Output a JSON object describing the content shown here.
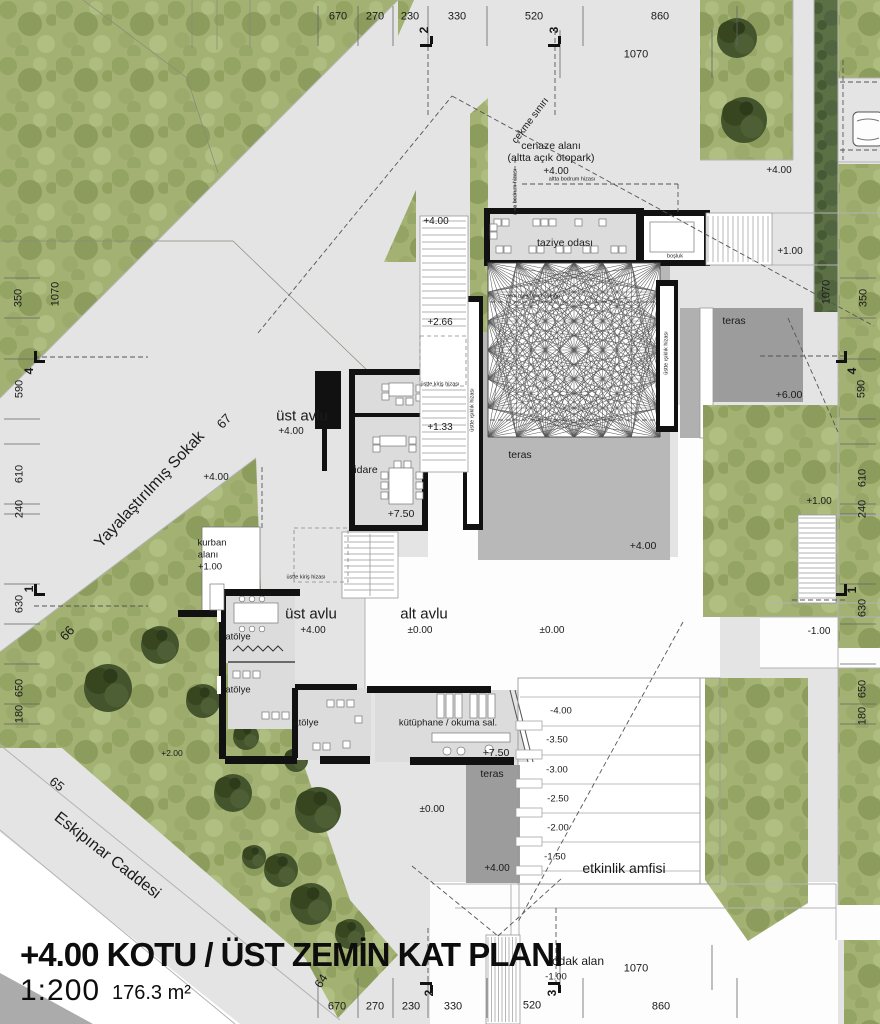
{
  "title": {
    "main": "+4.00 KOTU / ÜST ZEMİN KAT PLANI",
    "scale": "1:200",
    "area": "176.3 m²"
  },
  "plan": {
    "rooms": [
      "taziye odası",
      "boşluk",
      "cem meydanı boşluğu",
      "teras",
      "idare",
      "üst avlu",
      "alt avlu",
      "atölye",
      "kurban alanı",
      "kütüphane / okuma sal.",
      "etkinlik amfisi",
      "odak alan",
      "cenaze alanı (altta açık otopark)"
    ],
    "streets": [
      "Yayalaştırılmış Sokak",
      "Eskipınar Caddesi"
    ],
    "levels_shown": [
      "+7.50",
      "+6.00",
      "+4.00",
      "+2.66",
      "+2.00",
      "+1.33",
      "+1.00",
      "±0.00",
      "-1.00",
      "-1.50",
      "-2.00",
      "-2.50",
      "-3.00",
      "-3.50",
      "-4.00"
    ],
    "colors": {
      "grass": "#a3b173",
      "hedge": "#5b7044",
      "pavement": "#e4e4e4",
      "terrace_gray": "#9c9c9c",
      "terrace_light": "#b8b8b8",
      "wall": "#111111"
    }
  },
  "dimensions": {
    "top": [
      "670",
      "270",
      "230",
      "330",
      "520",
      "860",
      "1070"
    ],
    "bottom": [
      "670",
      "270",
      "230",
      "330",
      "520",
      "860",
      "1070"
    ],
    "left": [
      "350",
      "1070",
      "590",
      "610",
      "240",
      "630",
      "650",
      "180"
    ],
    "right": [
      "1070",
      "350",
      "590",
      "610",
      "240",
      "630",
      "650",
      "180"
    ],
    "section_markers": [
      "1",
      "2",
      "3",
      "4"
    ],
    "street_numbers": [
      "64",
      "65",
      "66",
      "67"
    ]
  },
  "labels": [
    {
      "n": "dim-top-670",
      "t": "670",
      "x": 338,
      "y": 17,
      "s": 11
    },
    {
      "n": "dim-top-270",
      "t": "270",
      "x": 375,
      "y": 17,
      "s": 11
    },
    {
      "n": "dim-top-230",
      "t": "230",
      "x": 410,
      "y": 17,
      "s": 11
    },
    {
      "n": "dim-top-330",
      "t": "330",
      "x": 457,
      "y": 17,
      "s": 11
    },
    {
      "n": "dim-top-520",
      "t": "520",
      "x": 534,
      "y": 17,
      "s": 11
    },
    {
      "n": "dim-top-860",
      "t": "860",
      "x": 660,
      "y": 17,
      "s": 11
    },
    {
      "n": "dim-top-1070",
      "t": "1070",
      "x": 636,
      "y": 55,
      "s": 11
    },
    {
      "n": "dim-bottom-670",
      "t": "670",
      "x": 337,
      "y": 1007,
      "s": 11
    },
    {
      "n": "dim-bottom-270",
      "t": "270",
      "x": 375,
      "y": 1007,
      "s": 11
    },
    {
      "n": "dim-bottom-230",
      "t": "230",
      "x": 411,
      "y": 1007,
      "s": 11
    },
    {
      "n": "dim-bottom-330",
      "t": "330",
      "x": 453,
      "y": 1007,
      "s": 11
    },
    {
      "n": "dim-bottom-520",
      "t": "520",
      "x": 532,
      "y": 1006,
      "s": 11
    },
    {
      "n": "dim-bottom-860",
      "t": "860",
      "x": 661,
      "y": 1007,
      "s": 11
    },
    {
      "n": "dim-bottom-1070",
      "t": "1070",
      "x": 636,
      "y": 969,
      "s": 11
    },
    {
      "n": "dim-left-350",
      "t": "350",
      "x": 19,
      "y": 298,
      "r": -90,
      "s": 11
    },
    {
      "n": "dim-left-1070",
      "t": "1070",
      "x": 56,
      "y": 294,
      "r": -90,
      "s": 11
    },
    {
      "n": "dim-left-590",
      "t": "590",
      "x": 20,
      "y": 389,
      "r": -90,
      "s": 11
    },
    {
      "n": "dim-left-610",
      "t": "610",
      "x": 20,
      "y": 474,
      "r": -90,
      "s": 11
    },
    {
      "n": "dim-left-240",
      "t": "240",
      "x": 20,
      "y": 509,
      "r": -90,
      "s": 11
    },
    {
      "n": "dim-left-630",
      "t": "630",
      "x": 20,
      "y": 604,
      "r": -90,
      "s": 11
    },
    {
      "n": "dim-left-650",
      "t": "650",
      "x": 20,
      "y": 688,
      "r": -90,
      "s": 11
    },
    {
      "n": "dim-left-180",
      "t": "180",
      "x": 20,
      "y": 714,
      "r": -90,
      "s": 11
    },
    {
      "n": "dim-right-350",
      "t": "350",
      "x": 864,
      "y": 298,
      "r": -90,
      "s": 11
    },
    {
      "n": "dim-right-1070",
      "t": "1070",
      "x": 827,
      "y": 292,
      "r": -90,
      "s": 11
    },
    {
      "n": "dim-right-590",
      "t": "590",
      "x": 862,
      "y": 389,
      "r": -90,
      "s": 11
    },
    {
      "n": "dim-right-610",
      "t": "610",
      "x": 863,
      "y": 478,
      "r": -90,
      "s": 11
    },
    {
      "n": "dim-right-240",
      "t": "240",
      "x": 863,
      "y": 509,
      "r": -90,
      "s": 11
    },
    {
      "n": "dim-right-630",
      "t": "630",
      "x": 863,
      "y": 608,
      "r": -90,
      "s": 11
    },
    {
      "n": "dim-right-650",
      "t": "650",
      "x": 863,
      "y": 689,
      "r": -90,
      "s": 11
    },
    {
      "n": "dim-right-180",
      "t": "180",
      "x": 863,
      "y": 716,
      "r": -90,
      "s": 11
    },
    {
      "n": "section-marker-2-top",
      "t": "2",
      "x": 424,
      "y": 30,
      "r": -90,
      "s": 12,
      "w": 700
    },
    {
      "n": "section-marker-3-top",
      "t": "3",
      "x": 554,
      "y": 30,
      "r": -90,
      "s": 12,
      "w": 700
    },
    {
      "n": "section-marker-2-bottom",
      "t": "2",
      "x": 429,
      "y": 993,
      "r": -90,
      "s": 12,
      "w": 700
    },
    {
      "n": "section-marker-3-bottom",
      "t": "3",
      "x": 552,
      "y": 993,
      "r": -90,
      "s": 12,
      "w": 700
    },
    {
      "n": "section-marker-4-left",
      "t": "4",
      "x": 29,
      "y": 371,
      "r": -90,
      "s": 12,
      "w": 700
    },
    {
      "n": "section-marker-1-left",
      "t": "1",
      "x": 29,
      "y": 589,
      "r": -90,
      "s": 12,
      "w": 700
    },
    {
      "n": "section-marker-4-right",
      "t": "4",
      "x": 852,
      "y": 371,
      "r": -90,
      "s": 12,
      "w": 700
    },
    {
      "n": "section-marker-1-right",
      "t": "1",
      "x": 852,
      "y": 590,
      "r": -90,
      "s": 12,
      "w": 700
    },
    {
      "n": "street-name-sokak",
      "t": "Yayalaştırılmış Sokak",
      "x": 150,
      "y": 490,
      "r": -47,
      "s": 16
    },
    {
      "n": "street-no-67",
      "t": "67",
      "x": 224,
      "y": 421,
      "r": -47,
      "s": 13
    },
    {
      "n": "street-no-66",
      "t": "66",
      "x": 67,
      "y": 633,
      "r": -47,
      "s": 13
    },
    {
      "n": "street-name-caddesi",
      "t": "Eskipınar Caddesi",
      "x": 107,
      "y": 856,
      "r": 38,
      "s": 16
    },
    {
      "n": "street-no-65",
      "t": "65",
      "x": 57,
      "y": 784,
      "r": 38,
      "s": 13
    },
    {
      "n": "street-no-64",
      "t": "64",
      "x": 321,
      "y": 981,
      "r": -57,
      "s": 12
    },
    {
      "n": "setback-label",
      "t": "çekme sınırı",
      "x": 531,
      "y": 121,
      "r": -53,
      "s": 10
    },
    {
      "n": "room-cenaze-1",
      "t": "cenaze alanı",
      "x": 551,
      "y": 146,
      "s": 10.5
    },
    {
      "n": "room-cenaze-2",
      "t": "(altta açık otopark)",
      "x": 551,
      "y": 158,
      "s": 10.5
    },
    {
      "n": "level-cenaze",
      "t": "+4.00",
      "x": 556,
      "y": 172,
      "s": 10
    },
    {
      "n": "room-taziye",
      "t": "taziye odası",
      "x": 565,
      "y": 243,
      "s": 10.5
    },
    {
      "n": "room-bosluk",
      "t": "boşluk",
      "x": 675,
      "y": 257,
      "s": 5.5
    },
    {
      "n": "room-cem-meydani",
      "t": "cem meydanı boşluğu",
      "x": 533,
      "y": 297,
      "s": 5.5
    },
    {
      "n": "room-teras-1",
      "t": "teras",
      "x": 520,
      "y": 455,
      "s": 10.5
    },
    {
      "n": "room-teras-2",
      "t": "teras",
      "x": 734,
      "y": 321,
      "s": 10.5
    },
    {
      "n": "room-teras-3",
      "t": "teras",
      "x": 492,
      "y": 774,
      "s": 10.5
    },
    {
      "n": "room-idare",
      "t": "idare",
      "x": 366,
      "y": 470,
      "s": 10.5
    },
    {
      "n": "room-ust-avlu-1",
      "t": "üst avlu",
      "x": 302,
      "y": 416,
      "s": 15
    },
    {
      "n": "level-ust-avlu-1",
      "t": "+4.00",
      "x": 291,
      "y": 432,
      "s": 10
    },
    {
      "n": "room-ust-avlu-2",
      "t": "üst avlu",
      "x": 311,
      "y": 614,
      "s": 15
    },
    {
      "n": "level-ust-avlu-2",
      "t": "+4.00",
      "x": 313,
      "y": 631,
      "s": 10
    },
    {
      "n": "room-alt-avlu",
      "t": "alt avlu",
      "x": 424,
      "y": 614,
      "s": 15
    },
    {
      "n": "level-alt-avlu",
      "t": "±0.00",
      "x": 420,
      "y": 631,
      "s": 10
    },
    {
      "n": "room-atolye-1",
      "t": "atölye",
      "x": 238,
      "y": 637,
      "s": 9.5
    },
    {
      "n": "room-atolye-2",
      "t": "atölye",
      "x": 238,
      "y": 690,
      "s": 9.5
    },
    {
      "n": "room-atolye-3",
      "t": "atölye",
      "x": 306,
      "y": 723,
      "s": 9.5
    },
    {
      "n": "room-kurban-1",
      "t": "kurban",
      "x": 212,
      "y": 543,
      "s": 9.5
    },
    {
      "n": "room-kurban-2",
      "t": "alanı",
      "x": 208,
      "y": 555,
      "s": 9.5
    },
    {
      "n": "level-kurban",
      "t": "+1.00",
      "x": 210,
      "y": 567,
      "s": 9.5
    },
    {
      "n": "room-kutuphane",
      "t": "kütüphane /  okuma sal.",
      "x": 448,
      "y": 723,
      "s": 9.5
    },
    {
      "n": "room-etkinlik",
      "t": "etkinlik amfisi",
      "x": 624,
      "y": 868,
      "s": 14
    },
    {
      "n": "room-odak",
      "t": "odak alan",
      "x": 578,
      "y": 961,
      "s": 12
    },
    {
      "n": "level-odak",
      "t": "-1.00",
      "x": 556,
      "y": 977,
      "s": 9.5
    },
    {
      "n": "level-stair-top",
      "t": "+4.00",
      "x": 436,
      "y": 222,
      "s": 10
    },
    {
      "n": "level-right-road",
      "t": "+4.00",
      "x": 779,
      "y": 171,
      "s": 10
    },
    {
      "n": "level-green-tri",
      "t": "+4.00",
      "x": 216,
      "y": 478,
      "s": 10
    },
    {
      "n": "level-teras-1",
      "t": "+4.00",
      "x": 643,
      "y": 546,
      "s": 10.5
    },
    {
      "n": "level-teras-3",
      "t": "+4.00",
      "x": 497,
      "y": 869,
      "s": 10
    },
    {
      "n": "level-266",
      "t": "+2.66",
      "x": 440,
      "y": 323,
      "s": 10
    },
    {
      "n": "level-133",
      "t": "+1.33",
      "x": 440,
      "y": 428,
      "s": 10
    },
    {
      "n": "level-idare",
      "t": "+7.50",
      "x": 401,
      "y": 514,
      "s": 10.5
    },
    {
      "n": "level-kutuphane",
      "t": "+7.50",
      "x": 496,
      "y": 753,
      "s": 10.5
    },
    {
      "n": "level-stairs-ne",
      "t": "+1.00",
      "x": 790,
      "y": 252,
      "s": 10
    },
    {
      "n": "level-stairs-e",
      "t": "+1.00",
      "x": 819,
      "y": 502,
      "s": 10
    },
    {
      "n": "level-teras-2",
      "t": "+6.00",
      "x": 789,
      "y": 395,
      "s": 10.5
    },
    {
      "n": "level-plus2",
      "t": "+2.00",
      "x": 172,
      "y": 753,
      "s": 8.5
    },
    {
      "n": "level-zero-2",
      "t": "±0.00",
      "x": 552,
      "y": 631,
      "s": 10
    },
    {
      "n": "level-zero-3",
      "t": "±0.00",
      "x": 432,
      "y": 810,
      "s": 10
    },
    {
      "n": "level-minus1-road",
      "t": "-1.00",
      "x": 819,
      "y": 632,
      "s": 10
    },
    {
      "n": "step-minus400",
      "t": "-4.00",
      "x": 561,
      "y": 711,
      "s": 9.5
    },
    {
      "n": "step-minus350",
      "t": "-3.50",
      "x": 557,
      "y": 740,
      "s": 9.5
    },
    {
      "n": "step-minus300",
      "t": "-3.00",
      "x": 557,
      "y": 770,
      "s": 9.5
    },
    {
      "n": "step-minus250",
      "t": "-2.50",
      "x": 558,
      "y": 799,
      "s": 9.5
    },
    {
      "n": "step-minus200",
      "t": "-2.00",
      "x": 558,
      "y": 828,
      "s": 9.5
    },
    {
      "n": "step-minus150",
      "t": "-1.50",
      "x": 555,
      "y": 857,
      "s": 9.5
    },
    {
      "n": "note-bodrum-v",
      "t": "altta bodrum hizası",
      "x": 516,
      "y": 192,
      "r": -90,
      "s": 5.5
    },
    {
      "n": "note-bodrum-h",
      "t": "altta bodrum hizası",
      "x": 572,
      "y": 180,
      "s": 5.5
    },
    {
      "n": "note-kiris-1",
      "t": "üstte kiriş hizası",
      "x": 440,
      "y": 385,
      "s": 5.5
    },
    {
      "n": "note-kiris-2",
      "t": "üstte kiriş hizası",
      "x": 306,
      "y": 578,
      "s": 5.5
    },
    {
      "n": "note-isiklik-left",
      "t": "üstte ışıklık hizası",
      "x": 473,
      "y": 410,
      "r": -90,
      "s": 5.5
    },
    {
      "n": "note-isiklik-right",
      "t": "üstte ışıklık hizası",
      "x": 667,
      "y": 353,
      "r": -90,
      "s": 5.5
    }
  ]
}
